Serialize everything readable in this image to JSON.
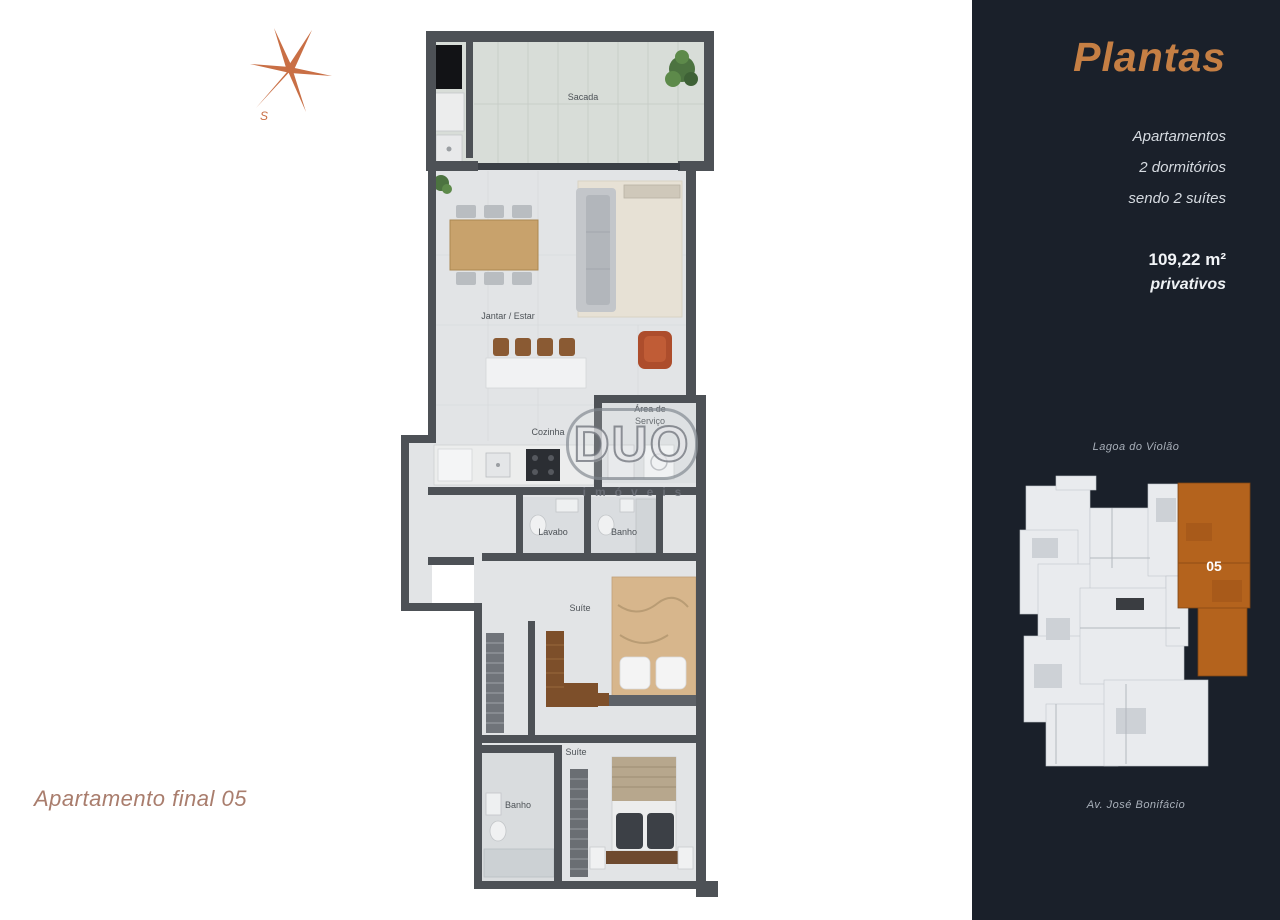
{
  "page": {
    "background": "#ffffff"
  },
  "compass": {
    "south_label": "S",
    "color": "#c96f45"
  },
  "caption": {
    "text": "Apartamento final 05",
    "color": "#a97d6d"
  },
  "watermark": {
    "brand": "DUO",
    "subtext": "imóveis"
  },
  "floorplan": {
    "labels": {
      "sacada": "Sacada",
      "jantar_estar": "Jantar / Estar",
      "cozinha": "Cozinha",
      "area_servico_line1": "Área de",
      "area_servico_line2": "Serviço",
      "lavabo": "Lavabo",
      "banho": "Banho",
      "suite_1": "Suíte",
      "suite_2": "Suíte",
      "banho_suite": "Banho"
    }
  },
  "panel": {
    "title": "Plantas",
    "description_lines": [
      "Apartamentos",
      "2 dormitórios",
      "sendo 2 suítes"
    ],
    "area_value": "109,22 m²",
    "area_note": "privativos",
    "keyplan": {
      "top_label": "Lagoa do Violão",
      "bottom_label": "Av. José Bonifácio",
      "unit_label": "05"
    },
    "colors": {
      "background": "#1a202a",
      "accent": "#c57f44",
      "unit_highlight": "#b4631d",
      "text": "#d7dbe1",
      "wall": "#4d5156"
    }
  }
}
